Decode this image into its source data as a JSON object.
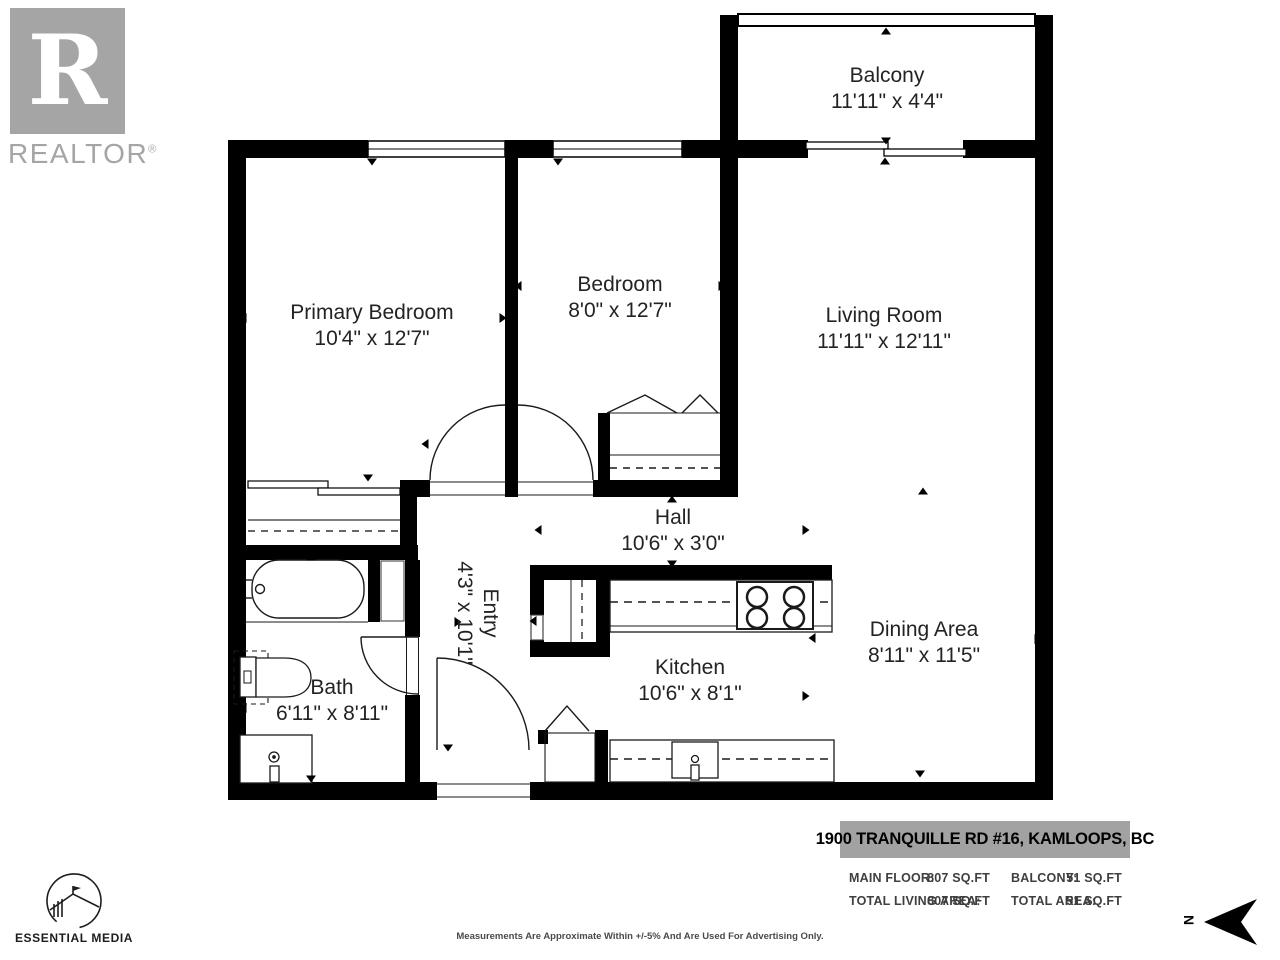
{
  "branding": {
    "realtor_logo_letter": "R",
    "realtor_logo_word": "REALTOR",
    "realtor_registered": "®",
    "media_logo_text": "ESSENTIAL MEDIA"
  },
  "plan": {
    "rooms": [
      {
        "name": "Balcony",
        "dims": "11'11\" x 4'4\""
      },
      {
        "name": "Primary Bedroom",
        "dims": "10'4\" x 12'7\""
      },
      {
        "name": "Bedroom",
        "dims": "8'0\" x 12'7\""
      },
      {
        "name": "Living Room",
        "dims": "11'11\" x 12'11\""
      },
      {
        "name": "Hall",
        "dims": "10'6\" x 3'0\""
      },
      {
        "name": "Entry",
        "dims": "4'3\" x 10'1\""
      },
      {
        "name": "Kitchen",
        "dims": "10'6\" x 8'1\""
      },
      {
        "name": "Dining Area",
        "dims": "8'11\" x 11'5\""
      },
      {
        "name": "Bath",
        "dims": "6'11\" x 8'11\""
      }
    ]
  },
  "footer": {
    "address": "1900 TRANQUILLE RD #16, KAMLOOPS, BC",
    "stats": [
      {
        "label": "MAIN FLOOR:",
        "value": "807 SQ.FT"
      },
      {
        "label": "BALCONY:",
        "value": "51 SQ.FT"
      },
      {
        "label": "TOTAL LIVING AREA:",
        "value": "807 SQ.FT"
      },
      {
        "label": "TOTAL AREA:",
        "value": "51 SQ.FT"
      }
    ],
    "disclaimer": "Measurements Are Approximate Within +/-5% And Are Used For Advertising Only.",
    "north_label": "N"
  },
  "colors": {
    "wall": "#000000",
    "logo_gray": "#a5a5a5",
    "banner_gray": "#a2a2a2",
    "label_text": "#232323"
  }
}
